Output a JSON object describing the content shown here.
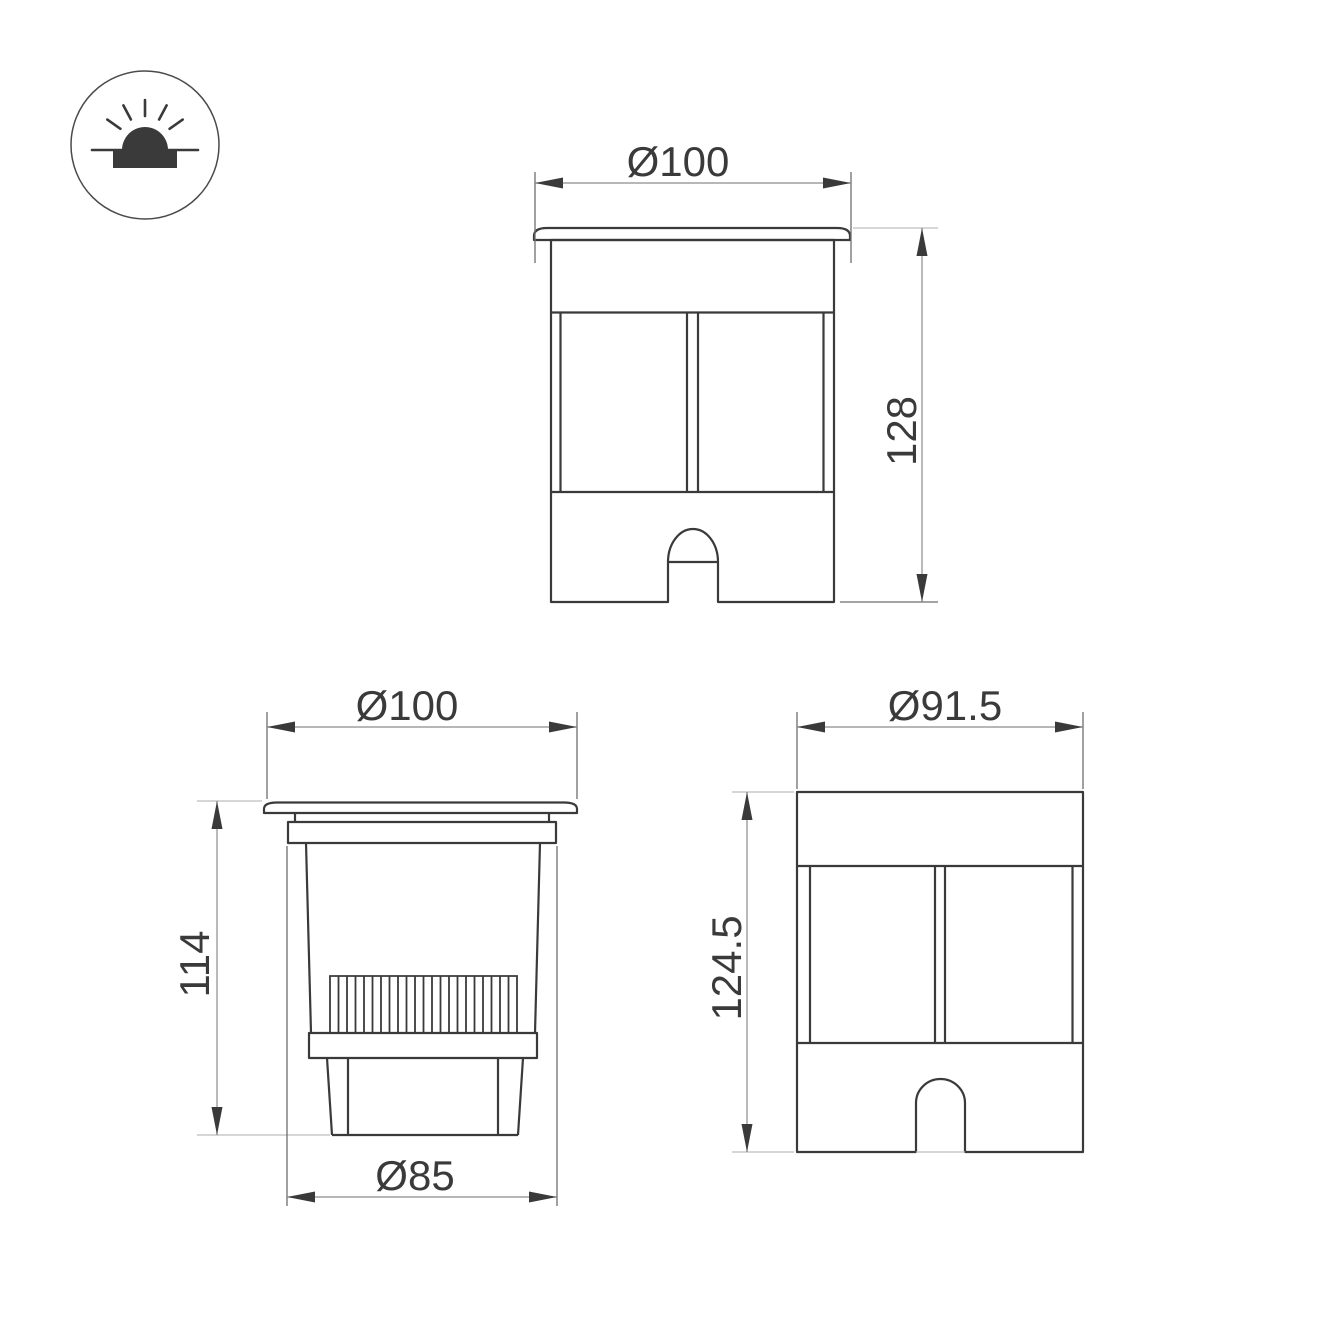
{
  "icon": {
    "name": "recessed-ground-light",
    "meaning": "luminaire recessed into ground, light emitting upward"
  },
  "views": {
    "front": {
      "width": "Ø100",
      "height": "128"
    },
    "section": {
      "top_width": "Ø100",
      "height": "114",
      "bottom_width": "Ø85"
    },
    "rear": {
      "width": "Ø91.5",
      "height": "124.5"
    }
  },
  "colors": {
    "background": "#ffffff",
    "object_line": "#3a3a3a",
    "dimension_line": "#8c8c8c",
    "extension_line": "#6e6e6e",
    "light_line": "#bdbdbd",
    "text": "#3a3a3a"
  }
}
